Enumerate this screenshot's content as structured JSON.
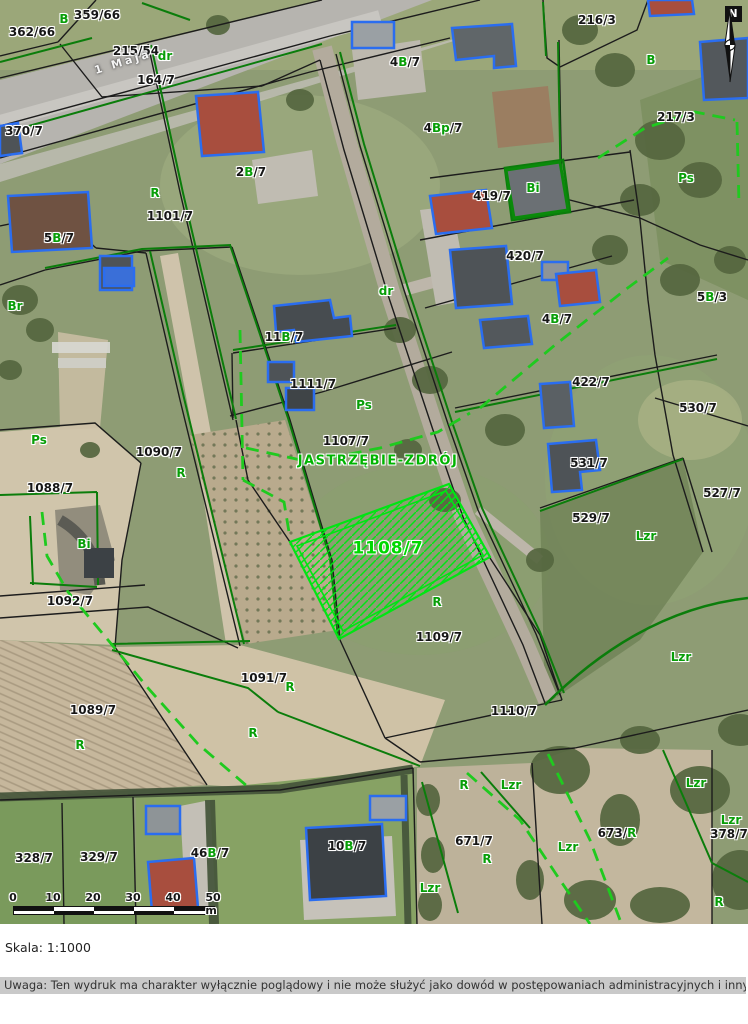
{
  "map": {
    "street_label": {
      "text": "1 Maja",
      "x": 123,
      "y": 62
    },
    "city_boundary_label": {
      "text": "JASTRZĘBIE-ZDRÓJ",
      "x": 378,
      "y": 461
    },
    "selected_parcel": {
      "label": "1108/7",
      "x": 388,
      "y": 549
    },
    "north_label": "N",
    "parcel_labels": [
      {
        "text": "362/66",
        "x": 32,
        "y": 32
      },
      {
        "text": "359/66",
        "x": 97,
        "y": 15
      },
      {
        "text": "215/54",
        "x": 136,
        "y": 51
      },
      {
        "text": "164/7",
        "x": 156,
        "y": 80
      },
      {
        "text": "370/7",
        "x": 24,
        "y": 131
      },
      {
        "text": "1101/7",
        "x": 170,
        "y": 216
      },
      {
        "text": "216/3",
        "x": 597,
        "y": 20
      },
      {
        "text": "217/3",
        "x": 676,
        "y": 117
      },
      {
        "text": "419/7",
        "x": 492,
        "y": 196
      },
      {
        "text": "420/7",
        "x": 525,
        "y": 256
      },
      {
        "text": "422/7",
        "x": 591,
        "y": 382
      },
      {
        "text": "530/7",
        "x": 698,
        "y": 408
      },
      {
        "text": "531/7",
        "x": 589,
        "y": 463
      },
      {
        "text": "527/7",
        "x": 722,
        "y": 493
      },
      {
        "text": "529/7",
        "x": 591,
        "y": 518
      },
      {
        "text": "1088/7",
        "x": 50,
        "y": 488
      },
      {
        "text": "1090/7",
        "x": 159,
        "y": 452
      },
      {
        "text": "1092/7",
        "x": 70,
        "y": 601
      },
      {
        "text": "1089/7",
        "x": 93,
        "y": 710
      },
      {
        "text": "1091/7",
        "x": 264,
        "y": 678
      },
      {
        "text": "1107/7",
        "x": 346,
        "y": 441
      },
      {
        "text": "1111/7",
        "x": 313,
        "y": 384
      },
      {
        "text": "1109/7",
        "x": 439,
        "y": 637
      },
      {
        "text": "1110/7",
        "x": 514,
        "y": 711
      },
      {
        "text": "328/7",
        "x": 34,
        "y": 858
      },
      {
        "text": "329/7",
        "x": 99,
        "y": 857
      },
      {
        "text": "671/7",
        "x": 474,
        "y": 841
      },
      {
        "text": "378/7",
        "x": 729,
        "y": 834
      }
    ],
    "landuse_labels": [
      {
        "text": "B",
        "x": 64,
        "y": 19
      },
      {
        "text": "dr",
        "x": 165,
        "y": 56
      },
      {
        "text": "R",
        "x": 155,
        "y": 193
      },
      {
        "text": "B",
        "x": 651,
        "y": 60
      },
      {
        "text": "Ps",
        "x": 686,
        "y": 178
      },
      {
        "text": "Bi",
        "x": 533,
        "y": 188
      },
      {
        "text": "Br",
        "x": 15,
        "y": 306
      },
      {
        "text": "Ps",
        "x": 39,
        "y": 440
      },
      {
        "text": "R",
        "x": 181,
        "y": 473
      },
      {
        "text": "Bi",
        "x": 84,
        "y": 544
      },
      {
        "text": "Ps",
        "x": 364,
        "y": 405
      },
      {
        "text": "dr",
        "x": 386,
        "y": 291
      },
      {
        "text": "Lzr",
        "x": 646,
        "y": 536
      },
      {
        "text": "Lzr",
        "x": 681,
        "y": 657
      },
      {
        "text": "R",
        "x": 437,
        "y": 602
      },
      {
        "text": "R",
        "x": 80,
        "y": 745
      },
      {
        "text": "R",
        "x": 290,
        "y": 687
      },
      {
        "text": "R",
        "x": 253,
        "y": 733
      },
      {
        "text": "R",
        "x": 464,
        "y": 785
      },
      {
        "text": "Lzr",
        "x": 511,
        "y": 785
      },
      {
        "text": "R",
        "x": 487,
        "y": 859
      },
      {
        "text": "Lzr",
        "x": 430,
        "y": 888
      },
      {
        "text": "Lzr",
        "x": 568,
        "y": 847
      },
      {
        "text": "Lzr",
        "x": 696,
        "y": 783
      },
      {
        "text": "Lzr",
        "x": 731,
        "y": 820
      },
      {
        "text": "R",
        "x": 719,
        "y": 902
      }
    ],
    "composite_labels": [
      {
        "x": 251,
        "y": 172,
        "parts": [
          [
            "2",
            "k"
          ],
          [
            "B",
            "g"
          ],
          [
            "/7",
            "k"
          ]
        ]
      },
      {
        "x": 405,
        "y": 62,
        "parts": [
          [
            "4",
            "k"
          ],
          [
            "B",
            "g"
          ],
          [
            "/7",
            "k"
          ]
        ]
      },
      {
        "x": 443,
        "y": 128,
        "parts": [
          [
            "4",
            "k"
          ],
          [
            "Bp",
            "g"
          ],
          [
            "/7",
            "k"
          ]
        ]
      },
      {
        "x": 59,
        "y": 238,
        "parts": [
          [
            "5",
            "k"
          ],
          [
            "B",
            "g"
          ],
          [
            "/7",
            "k"
          ]
        ]
      },
      {
        "x": 284,
        "y": 337,
        "parts": [
          [
            "11",
            "k"
          ],
          [
            "B",
            "g"
          ],
          [
            "/7",
            "k"
          ]
        ]
      },
      {
        "x": 557,
        "y": 319,
        "parts": [
          [
            "4",
            "k"
          ],
          [
            "B",
            "g"
          ],
          [
            "/7",
            "k"
          ]
        ]
      },
      {
        "x": 712,
        "y": 297,
        "parts": [
          [
            "5",
            "k"
          ],
          [
            "B",
            "g"
          ],
          [
            "/3",
            "k"
          ]
        ]
      },
      {
        "x": 210,
        "y": 853,
        "parts": [
          [
            "46",
            "k"
          ],
          [
            "B",
            "g"
          ],
          [
            "/7",
            "k"
          ]
        ]
      },
      {
        "x": 347,
        "y": 846,
        "parts": [
          [
            "10",
            "k"
          ],
          [
            "B",
            "g"
          ],
          [
            "/7",
            "k"
          ]
        ]
      },
      {
        "x": 617,
        "y": 833,
        "parts": [
          [
            "673/",
            "k"
          ],
          [
            "R",
            "g"
          ]
        ]
      }
    ]
  },
  "scalebar": {
    "ticks": [
      "0",
      "10",
      "20",
      "30",
      "40",
      "50 m"
    ]
  },
  "footer": {
    "scale_text": "Skala: 1:1000",
    "disclaimer": "Uwaga: Ten wydruk ma charakter wyłącznie poglądowy i nie może służyć jako dowód w postępowaniach administracyjnych i innych."
  },
  "colors": {
    "selected_parcel": "#00e513",
    "municipal_boundary": "#1fca1f",
    "landuse_line": "#0b7d0b",
    "parcel_line": "#1c1c1c",
    "building_outline": "#2a6df0",
    "landuse_text": "#089e08",
    "selected_text": "#00d800"
  }
}
